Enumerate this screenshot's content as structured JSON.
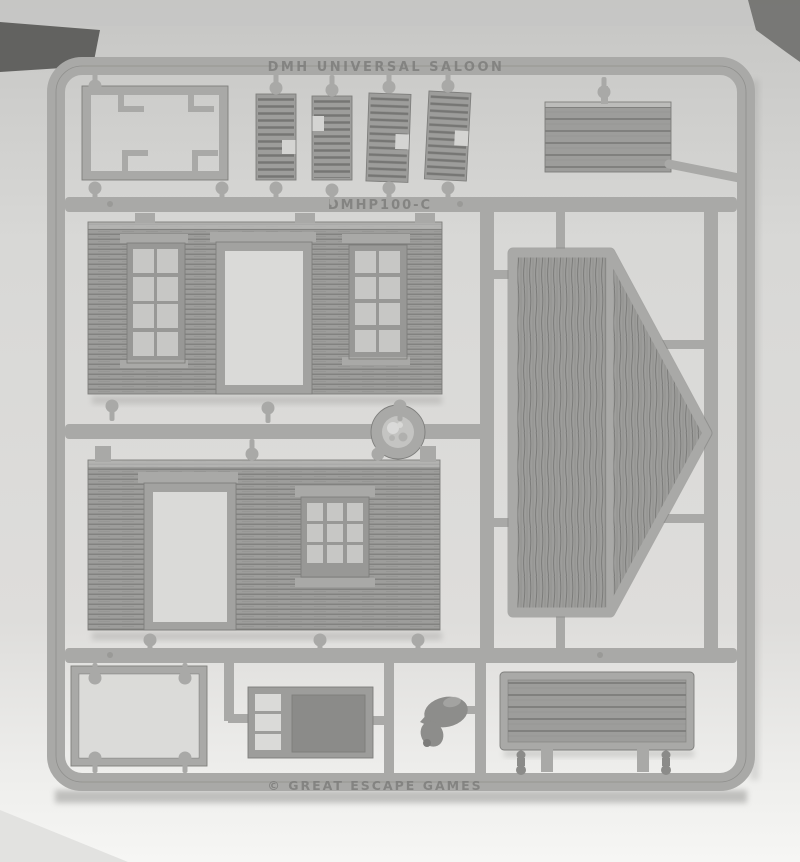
{
  "photo": {
    "type": "photograph",
    "subject": "grey injection-moulded plastic sprue of wild-west wooden building parts photographed on white paper",
    "markings": {
      "top_rail_text": "DMH UNIVERSAL SALOON",
      "product_code": "DMHP100-C",
      "bottom_rail_text": "© GREAT ESCAPE GAMES"
    },
    "parts": [
      {
        "name": "base-frame",
        "desc": "open rectangular frame with four L-shaped mounting tabs"
      },
      {
        "name": "louvered-shutters",
        "count": 4,
        "desc": "four small louvered shutter / step pieces"
      },
      {
        "name": "planked-panel-small",
        "desc": "small horizontally planked awning panel"
      },
      {
        "name": "upper-wall",
        "desc": "clapboard wall with two eight-pane windows and central open doorway"
      },
      {
        "name": "gable-roof-end",
        "desc": "pentagonal vertical-planked gable end, apex pointing right"
      },
      {
        "name": "sprue-gate-disc",
        "desc": "round injection gate disc with rough textured centre"
      },
      {
        "name": "lower-wall",
        "desc": "clapboard wall with left doorway and nine-pane window"
      },
      {
        "name": "window-frame",
        "desc": "plain rectangular window frame"
      },
      {
        "name": "shelf-table",
        "desc": "piece with three open shelves and a solid table top"
      },
      {
        "name": "pig-figure",
        "desc": "small pig miniature"
      },
      {
        "name": "boardwalk-section",
        "desc": "planked boardwalk section with raised border"
      },
      {
        "name": "small-fittings",
        "count": 2,
        "desc": "two tiny knob fittings"
      }
    ]
  },
  "colors": {
    "paper_top": "#c6c6c4",
    "paper_mid": "#d8d8d6",
    "paper_low": "#e6e6e4",
    "paper_bottom": "#f6f6f4",
    "corner_dark": "#565654",
    "corner_dark2": "#6f6f6d",
    "plastic": "#a9a9a7",
    "plastic_light": "#bcbcba",
    "plastic_dark": "#7e7e7c",
    "part_face": "#9d9d9b",
    "grain": "#6f6f6d",
    "pane": "#c7c7c5",
    "opening": "#dadad8",
    "emboss": "#7b7b79",
    "pig": "#8d8d8b",
    "panel_dark": "#8b8b89",
    "shadow": "#777775"
  }
}
